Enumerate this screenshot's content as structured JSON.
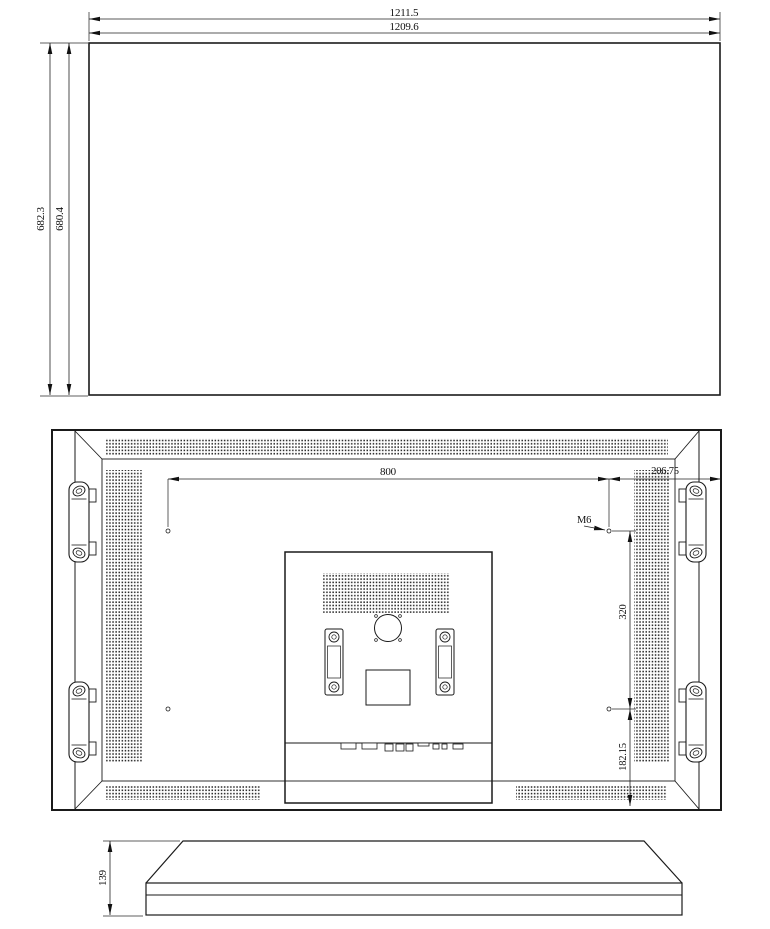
{
  "colors": {
    "line": "#1a1a1a",
    "background": "#ffffff"
  },
  "views": {
    "front": {
      "dims": {
        "width_outer": "1211.5",
        "width_inner": "1209.6",
        "height_outer": "682.3",
        "height_inner": "680.4"
      }
    },
    "rear": {
      "dims": {
        "mount_width": "800",
        "right_offset": "206.75",
        "mount_thread": "M6",
        "mount_height": "320",
        "bottom_offset": "182.15"
      }
    },
    "side": {
      "dims": {
        "depth": "139"
      }
    }
  }
}
